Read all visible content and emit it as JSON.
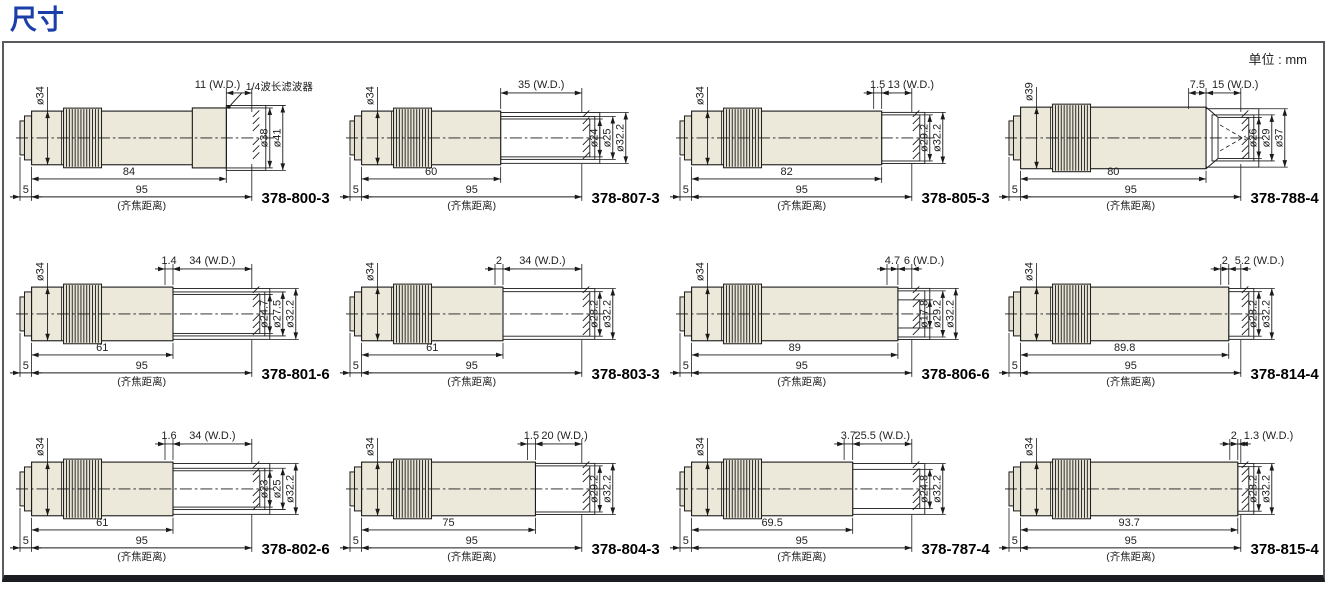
{
  "page": {
    "title": "尺寸",
    "unit_note": "单位 : mm"
  },
  "colors": {
    "accent_blue": "#1b3fa8",
    "line": "#1a1a1a",
    "body_fill": "#ece8da",
    "cap_fill": "#e4e0d2",
    "knurl_fill": "#e7e3d5",
    "dim_text": "#222222",
    "frame_border": "#595a5e",
    "bottom_bar": "#1b1b22"
  },
  "cells": [
    {
      "model": "378-800-3",
      "style": "filter",
      "offset_label": "",
      "wd_label": "11 (W.D.)",
      "left_dia_label": "ø34",
      "right_dia_labels": [
        "ø38",
        "ø41"
      ],
      "body_label": "84",
      "parfocal_label": "95",
      "flange_label": "5",
      "note": "(齐焦距离)",
      "annotation": "1/4波长滤波器"
    },
    {
      "model": "378-807-3",
      "style": "tube",
      "offset_label": "",
      "wd_label": "35 (W.D.)",
      "left_dia_label": "ø34",
      "right_dia_labels": [
        "ø24",
        "ø25",
        "ø32.2"
      ],
      "body_label": "60",
      "parfocal_label": "95",
      "flange_label": "5",
      "note": "(齐焦距离)"
    },
    {
      "model": "378-805-3",
      "style": "tube",
      "offset_label": "1.5",
      "wd_label": "13 (W.D.)",
      "left_dia_label": "ø34",
      "right_dia_labels": [
        "ø29.2",
        "ø32.2"
      ],
      "body_label": "82",
      "parfocal_label": "95",
      "flange_label": "5",
      "note": "(齐焦距离)"
    },
    {
      "model": "378-788-4",
      "style": "cone",
      "offset_label": "7.5",
      "wd_label": "15 (W.D.)",
      "left_dia_label": "ø39",
      "right_dia_labels": [
        "ø26",
        "ø29",
        "ø37"
      ],
      "body_label": "80",
      "parfocal_label": "95",
      "flange_label": "5",
      "note": "(齐焦距离)"
    },
    {
      "model": "378-801-6",
      "style": "tube",
      "offset_label": "1.4",
      "wd_label": "34 (W.D.)",
      "left_dia_label": "ø34",
      "right_dia_labels": [
        "ø24.7",
        "ø27.5",
        "ø32.2"
      ],
      "body_label": "61",
      "parfocal_label": "95",
      "flange_label": "5",
      "note": "(齐焦距离)"
    },
    {
      "model": "378-803-3",
      "style": "tube",
      "offset_label": "2",
      "wd_label": "34 (W.D.)",
      "left_dia_label": "ø34",
      "right_dia_labels": [
        "ø28.2",
        "ø32.2"
      ],
      "body_label": "61",
      "parfocal_label": "95",
      "flange_label": "5",
      "note": "(齐焦距离)"
    },
    {
      "model": "378-806-6",
      "style": "tube",
      "offset_label": "4.7",
      "wd_label": "6 (W.D.)",
      "left_dia_label": "ø34",
      "right_dia_labels": [
        "ø17.8",
        "ø29.2",
        "ø32.2"
      ],
      "body_label": "89",
      "parfocal_label": "95",
      "flange_label": "5",
      "note": "(齐焦距离)"
    },
    {
      "model": "378-814-4",
      "style": "tube",
      "offset_label": "2",
      "wd_label": "5.2 (W.D.)",
      "left_dia_label": "ø34",
      "right_dia_labels": [
        "ø28.2",
        "ø32.2"
      ],
      "body_label": "89.8",
      "parfocal_label": "95",
      "flange_label": "5",
      "note": "(齐焦距离)"
    },
    {
      "model": "378-802-6",
      "style": "tube",
      "offset_label": "1.6",
      "wd_label": "34 (W.D.)",
      "left_dia_label": "ø34",
      "right_dia_labels": [
        "ø23",
        "ø25",
        "ø32.2"
      ],
      "body_label": "61",
      "parfocal_label": "95",
      "flange_label": "5",
      "note": "(齐焦距离)"
    },
    {
      "model": "378-804-3",
      "style": "tube",
      "offset_label": "1.5",
      "wd_label": "20 (W.D.)",
      "left_dia_label": "ø34",
      "right_dia_labels": [
        "ø29.2",
        "ø32.2"
      ],
      "body_label": "75",
      "parfocal_label": "95",
      "flange_label": "5",
      "note": "(齐焦距离)"
    },
    {
      "model": "378-787-4",
      "style": "tube",
      "offset_label": "3.7",
      "wd_label": "25.5 (W.D.)",
      "left_dia_label": "ø34",
      "right_dia_labels": [
        "ø24.8",
        "ø32.2"
      ],
      "body_label": "69.5",
      "parfocal_label": "95",
      "flange_label": "5",
      "note": "(齐焦距离)"
    },
    {
      "model": "378-815-4",
      "style": "tube",
      "offset_label": "2",
      "wd_label": "1.3 (W.D.)",
      "left_dia_label": "ø34",
      "right_dia_labels": [
        "ø28.2",
        "ø32.2"
      ],
      "body_label": "93.7",
      "parfocal_label": "95",
      "flange_label": "5",
      "note": "(齐焦距离)"
    }
  ]
}
